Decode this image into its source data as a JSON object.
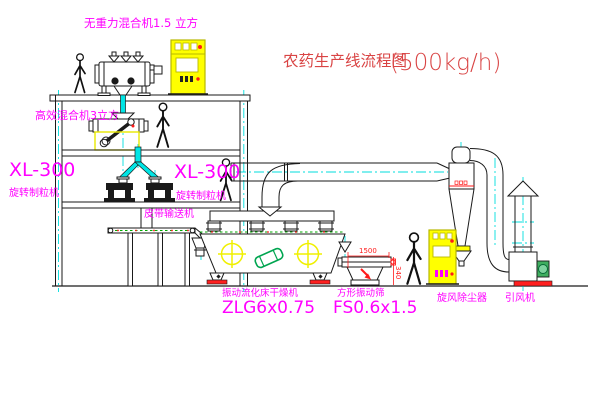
{
  "title": {
    "main": "农药生产线流程图",
    "capacity": "(500kg/h)"
  },
  "labels": {
    "top_mixer": "无重力混合机1.5 立方",
    "second_mixer": "高效混合机3立方",
    "granulator_model_1": "XL-300",
    "granulator_name_1": "旋转制粒机",
    "granulator_model_2": "XL-300",
    "granulator_name_2": "旋转制粒机",
    "belt_conveyor": "皮带输送机",
    "dryer_name": "振动流化床干燥机",
    "dryer_model": "ZLG6x0.75",
    "sieve_name": "方形振动筛",
    "sieve_model": "FS0.6x1.5",
    "cyclone": "旋风除尘器",
    "fan": "引风机"
  },
  "dimensions": {
    "sieve_length": "1500",
    "sieve_height": "340"
  },
  "colors": {
    "label_magenta": "#ff00ff",
    "title_red": "#d94444",
    "centerline_cyan": "#00dede",
    "dimension_red": "#ff1a1a",
    "cabinet_yellow": "#ffff00",
    "motor_green": "#3fae5f",
    "base_red": "#ff2020"
  }
}
